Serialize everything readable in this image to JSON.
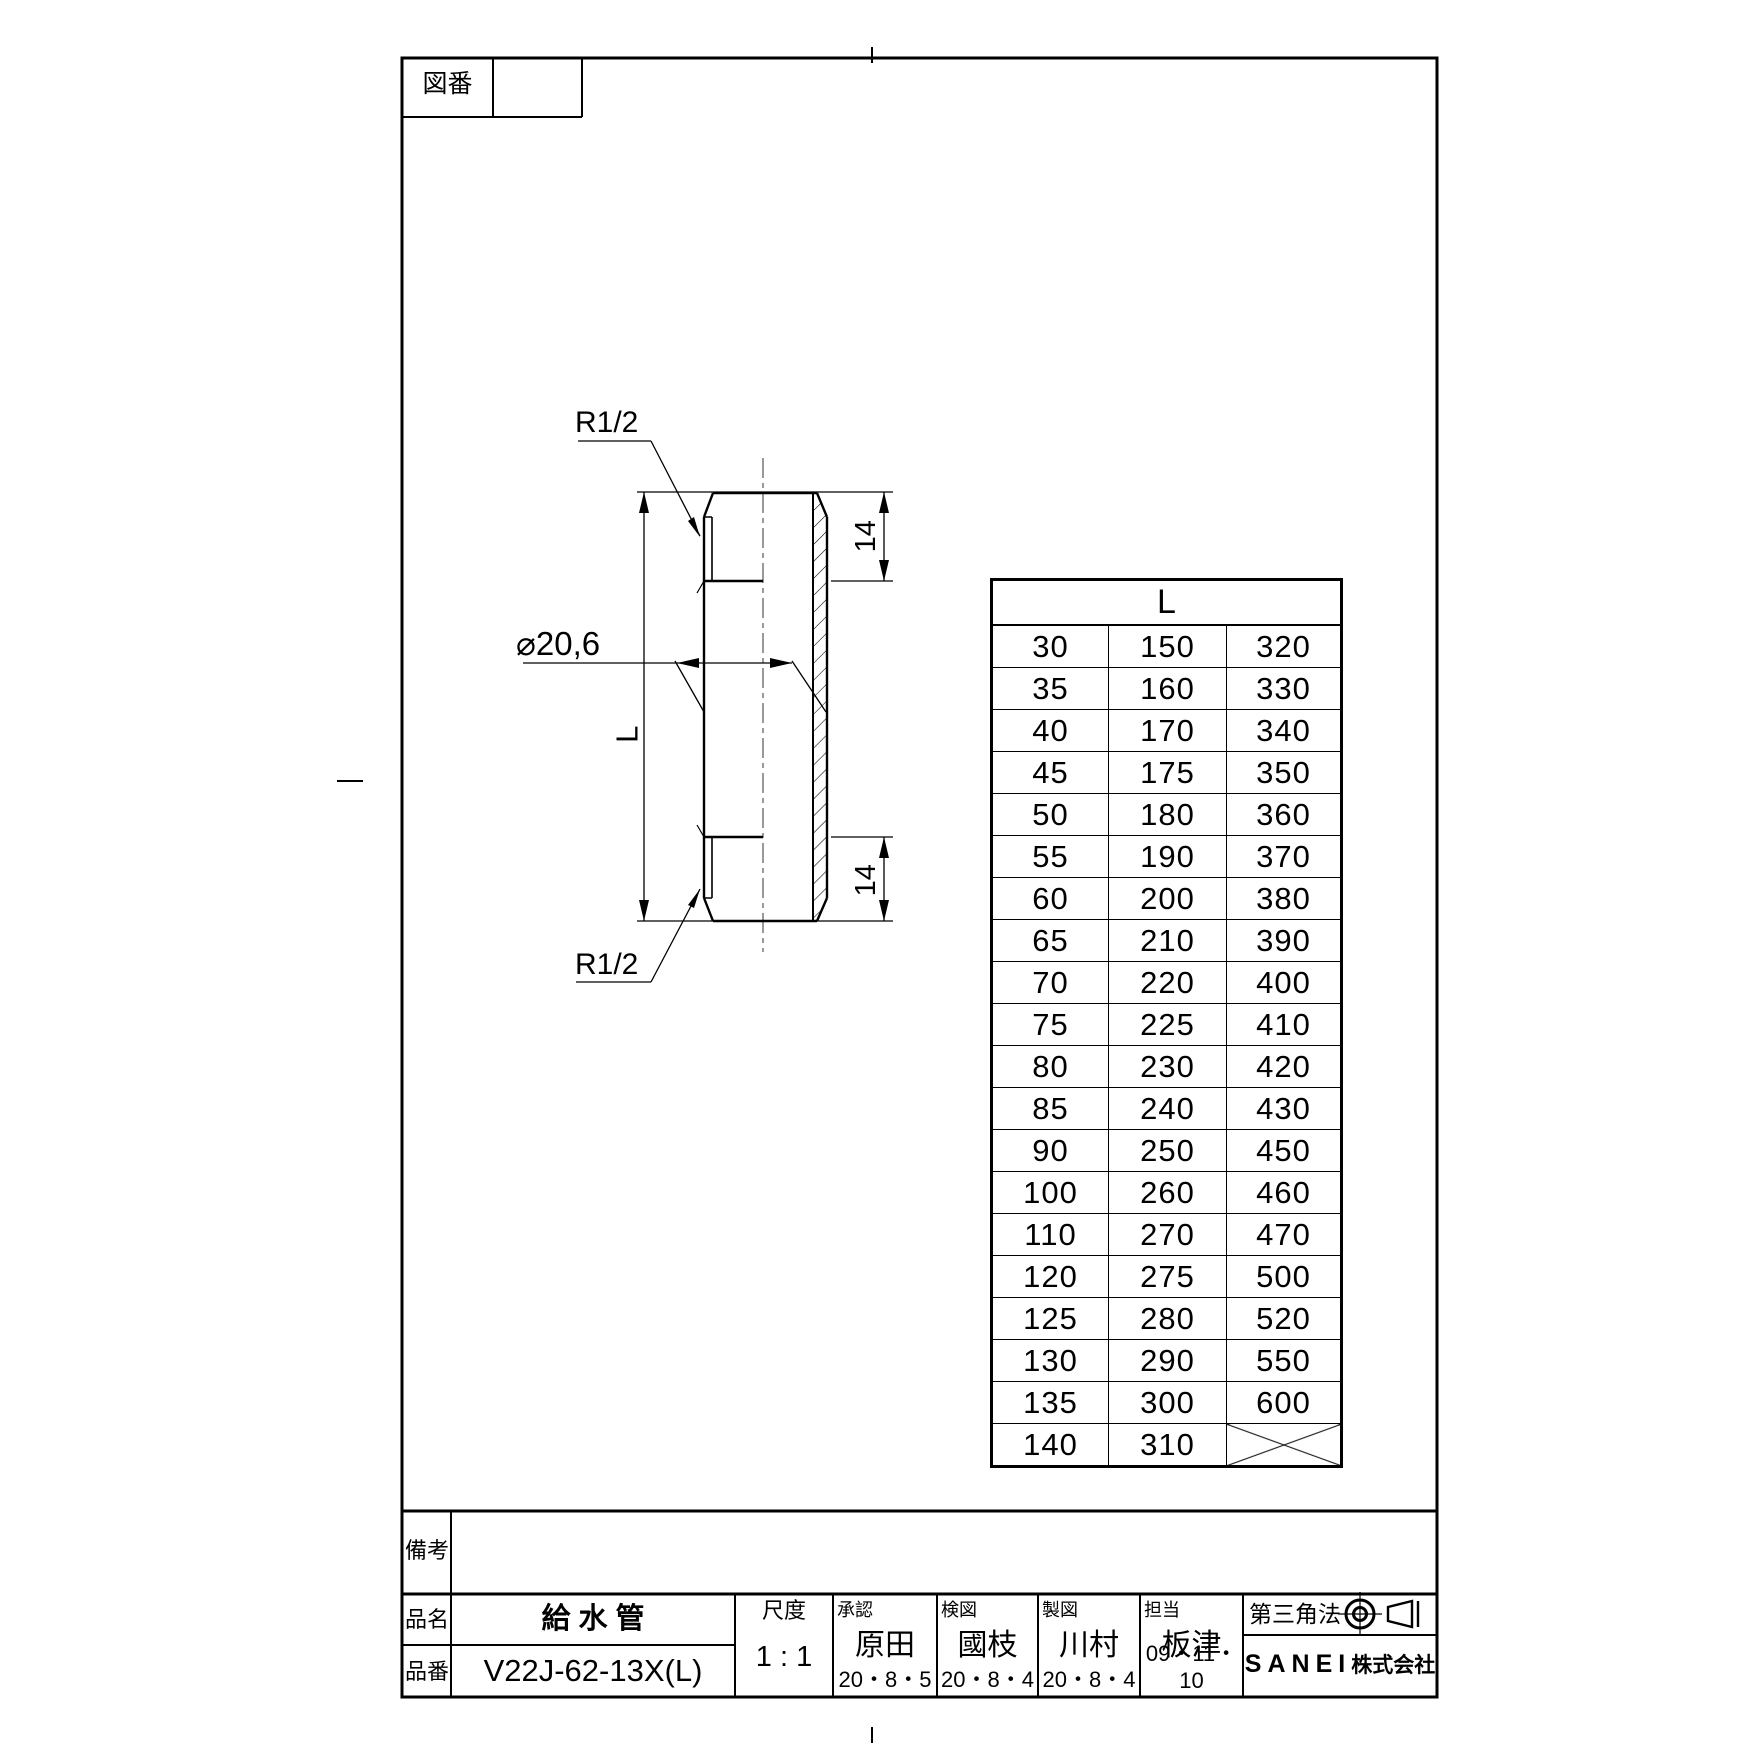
{
  "page": {
    "background": "#ffffff",
    "line_color": "#000000"
  },
  "zuban_box": {
    "label": "図番",
    "value": ""
  },
  "view": {
    "thread_label_top": "R1/2",
    "thread_label_bottom": "R1/2",
    "diameter_label": "⌀20,6",
    "length_label": "L",
    "thread_length_top": "14",
    "thread_length_bottom": "14"
  },
  "table": {
    "header": "L",
    "rows": [
      [
        "30",
        "150",
        "320"
      ],
      [
        "35",
        "160",
        "330"
      ],
      [
        "40",
        "170",
        "340"
      ],
      [
        "45",
        "175",
        "350"
      ],
      [
        "50",
        "180",
        "360"
      ],
      [
        "55",
        "190",
        "370"
      ],
      [
        "60",
        "200",
        "380"
      ],
      [
        "65",
        "210",
        "390"
      ],
      [
        "70",
        "220",
        "400"
      ],
      [
        "75",
        "225",
        "410"
      ],
      [
        "80",
        "230",
        "420"
      ],
      [
        "85",
        "240",
        "430"
      ],
      [
        "90",
        "250",
        "450"
      ],
      [
        "100",
        "260",
        "460"
      ],
      [
        "110",
        "270",
        "470"
      ],
      [
        "120",
        "275",
        "500"
      ],
      [
        "125",
        "280",
        "520"
      ],
      [
        "130",
        "290",
        "550"
      ],
      [
        "135",
        "300",
        "600"
      ],
      [
        "140",
        "310",
        ""
      ]
    ]
  },
  "title_block": {
    "remarks_label": "備考",
    "remarks_value": "",
    "product_name_label": "品名",
    "product_name": "給 水 管",
    "part_number_label": "品番",
    "part_number": "V22J-62-13X(L)",
    "scale_label": "尺度",
    "scale_value": "1 : 1",
    "approvers": [
      {
        "label": "承認",
        "name": "原田",
        "date": "20・8・5"
      },
      {
        "label": "検図",
        "name": "國枝",
        "date": "20・8・4"
      },
      {
        "label": "製図",
        "name": "川村",
        "date": "20・8・4"
      },
      {
        "label": "担当",
        "name": "板津",
        "date": "09・11・10"
      }
    ],
    "projection_label": "第三角法",
    "company_en": "SANEI",
    "company_jp": "株式会社"
  }
}
